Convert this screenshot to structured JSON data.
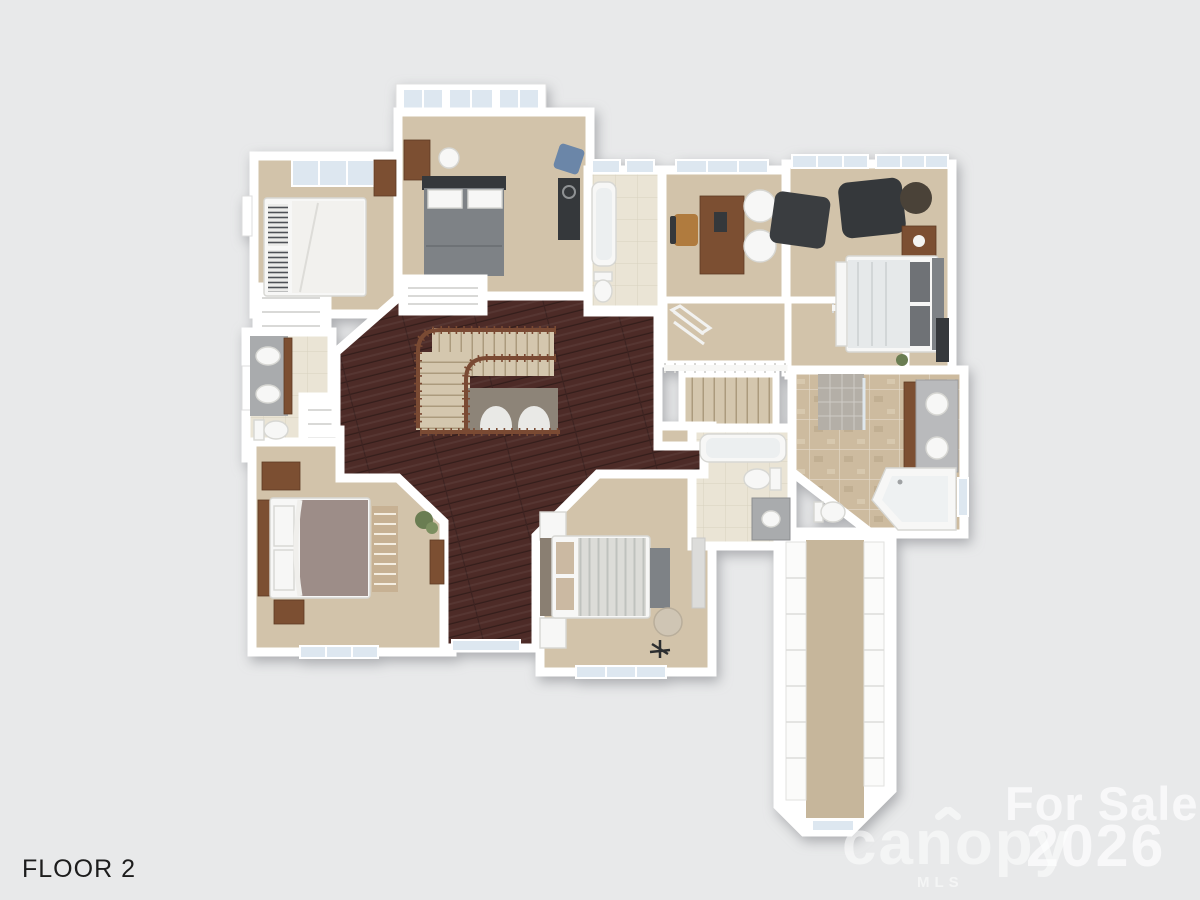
{
  "page": {
    "background": "#e8e9ea"
  },
  "floor_label": "FLOOR 2",
  "watermark": {
    "for_sale": "For Sale",
    "brand": "canopy",
    "mls": "MLS",
    "year": "2026"
  },
  "palette": {
    "bg": "#e8e9ea",
    "wall": "#ffffff",
    "wallEdge": "#d9dadc",
    "carpet": "#d2c3aa",
    "carpetDark": "#c6b69b",
    "wood": "#4d2b27",
    "tile": "#eae4d5",
    "travertine": "#cdbb9f",
    "fixture": "#f7f7f6",
    "cabinet": "#7c4f32",
    "benchWood": "#c7b193",
    "darkFurn": "#35383b",
    "grayBed": "#7e8286",
    "mauve": "#9d8d88",
    "railing": "#7a4a33",
    "glass": "#dde7f0",
    "granite": "#a9abad",
    "green": "#6a7d52",
    "textDark": "#1d1d1d"
  }
}
